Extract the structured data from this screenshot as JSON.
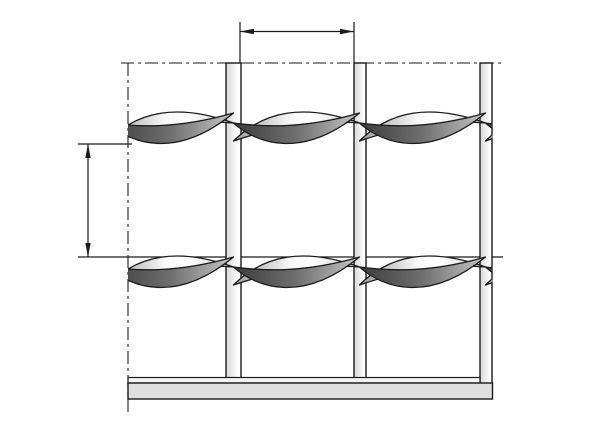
{
  "meta": {
    "description": "Technical line drawing of a press-locked steel grating panel (front view) with twisted cross bars, vertical bearing bars, bottom edge bar, section boundary centerlines and two unlabeled dimension arrows",
    "visible_text": []
  },
  "canvas": {
    "width": 600,
    "height": 424,
    "background": "#ffffff"
  },
  "colors": {
    "line": "#1a1a1a",
    "bar_fill_left": "#d7d7d7",
    "bar_fill_right": "#ffffff",
    "bottom_strip_fill": "#f4f4f4",
    "bottom_band_fill": "#dfdfdf",
    "leaf_light_stops": [
      "#9b9b9b",
      "#f7f7f7",
      "#cfcfcf"
    ],
    "leaf_dark_stops": [
      "#3c3c3c",
      "#6f6f6f",
      "#c6c6c6"
    ]
  },
  "section_boundary": {
    "style": "dash-dot",
    "dash_array": "13 4 3 4",
    "horizontal": {
      "y": 63,
      "x1": 121,
      "x2": 502
    },
    "vertical": {
      "x": 128,
      "y1": 63,
      "y2": 415
    }
  },
  "vertical_bars": [
    {
      "x": 226,
      "width": 15,
      "top": 63,
      "bottom": 379
    },
    {
      "x": 354,
      "width": 12,
      "top": 63,
      "bottom": 379
    },
    {
      "x": 480,
      "width": 12,
      "top": 63,
      "bottom": 384
    }
  ],
  "twisted_cross_bars": {
    "rows_y": [
      111,
      255
    ],
    "band_height": 37,
    "period": 126,
    "pattern_start_x": 107.5,
    "tiles_per_row": 4,
    "clip_x1": 128,
    "clip_x2": 492.5,
    "light_leaf_path": "M 0,30 C 30,0 70,-8 126,12 C 80,8 35,18 0,30 Z",
    "dark_leaf_path": "M 0,12 C 25,34 70,48 126,2 C 70,18 30,16 0,12 Z"
  },
  "bottom_edge": {
    "strip": {
      "x1": 128,
      "x2": 480,
      "y": 377.5,
      "height": 5.5
    },
    "band": {
      "x1": 128,
      "x2": 492.5,
      "y": 383,
      "height": 16
    }
  },
  "dimensions": {
    "horizontal_mesh_width": {
      "label": "",
      "line_y": 31.5,
      "tip1_x": 240,
      "tip2_x": 354,
      "ext_top_y": 22,
      "ext_bottom_y": 63
    },
    "vertical_mesh_height": {
      "label": "",
      "line_x": 88,
      "tip1_y": 144,
      "tip2_y": 257,
      "ext1": {
        "y": 144,
        "x1": 78,
        "x2": 132
      },
      "ext2": {
        "y": 257,
        "x1": 78,
        "x2": 503
      }
    },
    "arrowhead": {
      "length": 14,
      "half_width": 2.7
    }
  }
}
